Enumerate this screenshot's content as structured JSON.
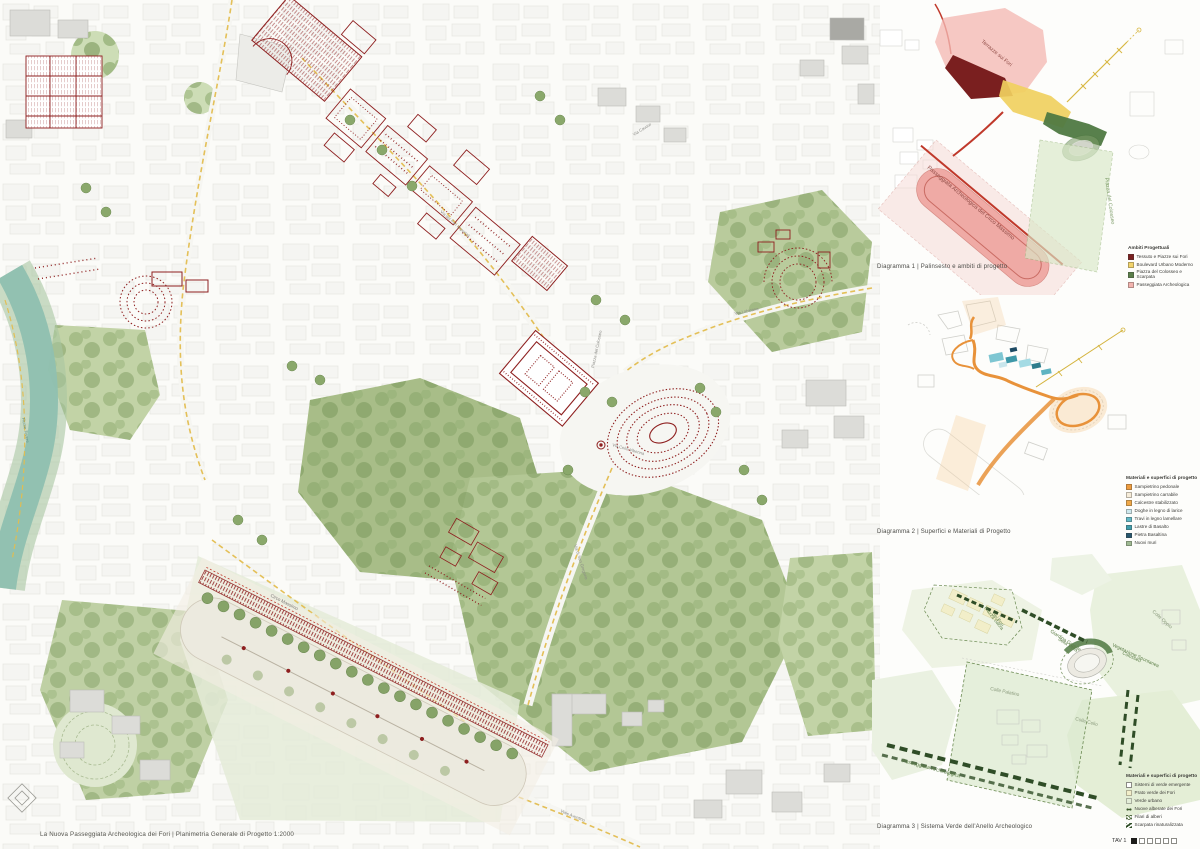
{
  "board": {
    "title_caption": "La Nuova Passeggiata Archeologica dei Fori | Planimetria Generale di Progetto 1:2000",
    "sheet_label": "TAV 1"
  },
  "main_map": {
    "labels": {
      "circo_massimo": "Circo Massimo",
      "piazza_del_colosseo": "Piazza del Colosseo",
      "via_dei_fori_imperiali": "Via dei Fori Imperiali",
      "via_di_san_gregorio": "Via di San Gregorio",
      "via_labicana": "Via Labicana",
      "viale_aventino": "Viale Aventino",
      "via_cavour": "Via Cavour",
      "via_celio_vibenna": "Via Celio Vibenna",
      "fiume_tevere": "Fiume Tevere"
    }
  },
  "diagram1": {
    "caption": "Diagramma 1 | Palinsesto e ambiti di progetto",
    "labels": {
      "terrazze_sui_fori": "Terrazze sui Fori",
      "piazza_del_colosseo": "Piazza del Colosseo",
      "passeggiata_circo": "Passeggiata Archeologica del Circo Massimo"
    },
    "legend": {
      "title": "Ambiti Progettuali",
      "items": [
        {
          "label": "Tessuto e Piazze sui Fori",
          "color": "#7a1f1f"
        },
        {
          "label": "Boulevard Urbano Moderno",
          "color": "#f2d36b"
        },
        {
          "label": "Piazza del Colosseo e Scarpata",
          "color": "#5b7f4a"
        },
        {
          "label": "Passeggiata Archeologica",
          "color": "#f2b3ae"
        }
      ]
    }
  },
  "diagram2": {
    "caption": "Diagramma 2 | Superfici e Materiali di Progetto",
    "legend": {
      "title": "Materiali e superfici di progetto",
      "items": [
        {
          "label": "Sampietrino pedonale",
          "color": "#ef9c3e"
        },
        {
          "label": "Sampietrino carrabile",
          "color": "#f6ecd9"
        },
        {
          "label": "Calcestre stabilizzato",
          "color": "#f0a848"
        },
        {
          "label": "Doghe in legno di larice",
          "color": "#cfe9ee"
        },
        {
          "label": "Travi in legno lamellare",
          "color": "#62b8c6"
        },
        {
          "label": "Lastre di Basalto",
          "color": "#3f9dac"
        },
        {
          "label": "Pietra Basaltina",
          "color": "#27566e"
        },
        {
          "label": "Nuovi muri",
          "color": "#9fba93"
        }
      ]
    }
  },
  "diagram3": {
    "caption": "Diagramma 3 | Sistema Verde dell'Anello Archeologico",
    "labels": {
      "piazza_sacra_line1": "Piazza Sacra",
      "piazza_sacra_line2": "dei Fori",
      "giardino_line1": "Giardino Grande",
      "giardino_line2": "della Velia",
      "vegetazione_line1": "Vegetazione Spontanea",
      "vegetazione_line2": "Colosseo",
      "colle_palatino": "Colle Palatino",
      "colle_celio": "Colle Celio",
      "colle_oppio": "Colle Oppio",
      "passeggiata": "Passeggiata Archeologica"
    },
    "legend": {
      "title": "Materiali e superfici di progetto",
      "items": [
        {
          "label": "Sistemi di verde emergente",
          "color": "#ffffff"
        },
        {
          "label": "Prato verde dei Fori",
          "color": "#f2eec9"
        },
        {
          "label": "Verde urbano",
          "color": "#e3edd8"
        },
        {
          "label": "Nuove alberate dei Fori",
          "color": "#3c5a2e"
        },
        {
          "label": "Filari di alberi",
          "color": "#5a7d46"
        },
        {
          "label": "Scarpata rinaturalizzata",
          "color": "#2e4d26"
        }
      ]
    }
  }
}
